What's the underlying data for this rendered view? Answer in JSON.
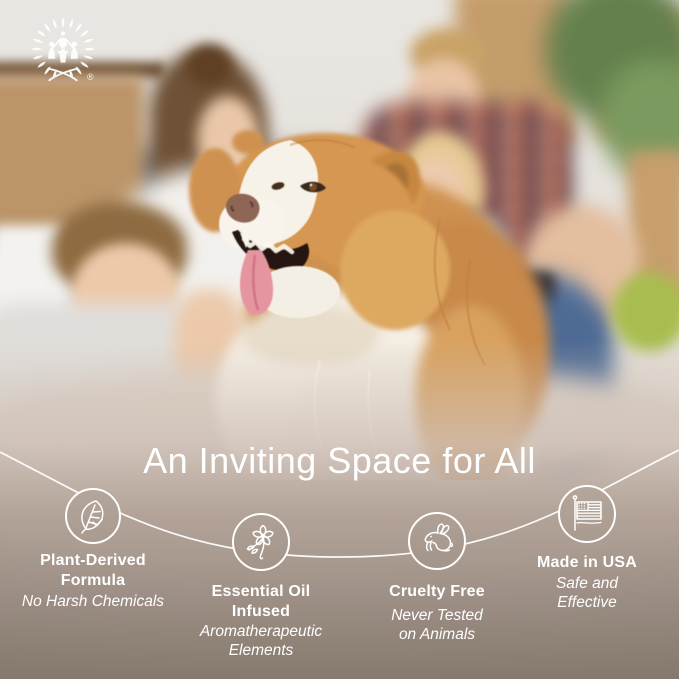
{
  "logo": {
    "name": "family-laurel-crest",
    "registered_mark": "®"
  },
  "heading": {
    "title": "An Inviting Space for All"
  },
  "features": [
    {
      "icon": "leaf-icon",
      "title": "Plant-Derived\nFormula",
      "subtitle": "No Harsh Chemicals"
    },
    {
      "icon": "flower-icon",
      "title": "Essential Oil\nInfused",
      "subtitle": "Aromatherapeutic\nElements"
    },
    {
      "icon": "rabbit-icon",
      "title": "Cruelty Free",
      "subtitle": "Never Tested\non Animals"
    },
    {
      "icon": "us-flag-icon",
      "title": "Made in USA",
      "subtitle": "Safe and\nEffective"
    }
  ],
  "colors": {
    "bottom_gradient_taupe": "#a2948a",
    "bottom_gradient_light": "#c6b9b1",
    "text_white": "#ffffff",
    "connector_line": "#ffffff",
    "dog_fur_gold": "#d29450",
    "plaid_red": "#bc5a3f"
  }
}
